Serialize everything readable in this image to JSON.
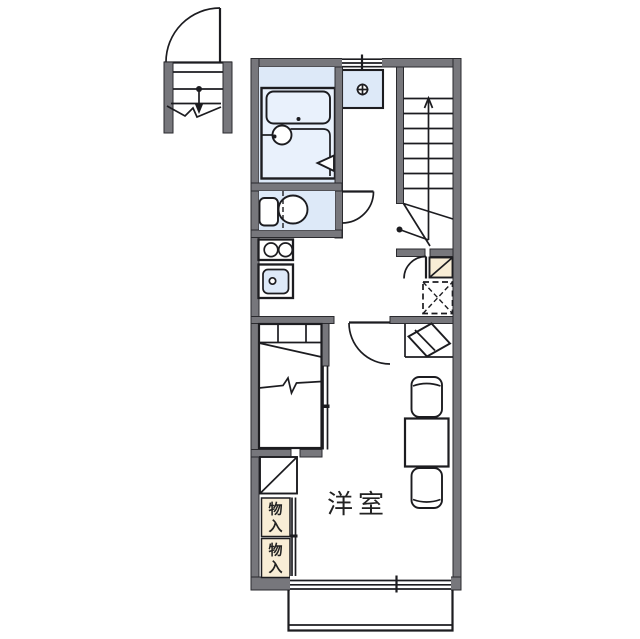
{
  "title": "apartment floor plan",
  "room": {
    "label": "洋室"
  },
  "closets": {
    "label": "物入",
    "chars": [
      "物",
      "入"
    ]
  },
  "symbols": {
    "stair_direction": "up-arrow",
    "washing_machine_drain": "circle-cross",
    "refrigerator_space": "dashed-box-x",
    "shoe_cabinet": "diagonal-box",
    "bathroom_folding_door": "triangle"
  },
  "colors": {
    "background": "#ffffff",
    "wall": "#77777c",
    "wall_edge": "#2a2a2e",
    "line": "#1c1c20",
    "wet_area": "#dde9f8",
    "tub": "#e9f1fc",
    "storage": "#f8edd6",
    "text": "#222222"
  }
}
